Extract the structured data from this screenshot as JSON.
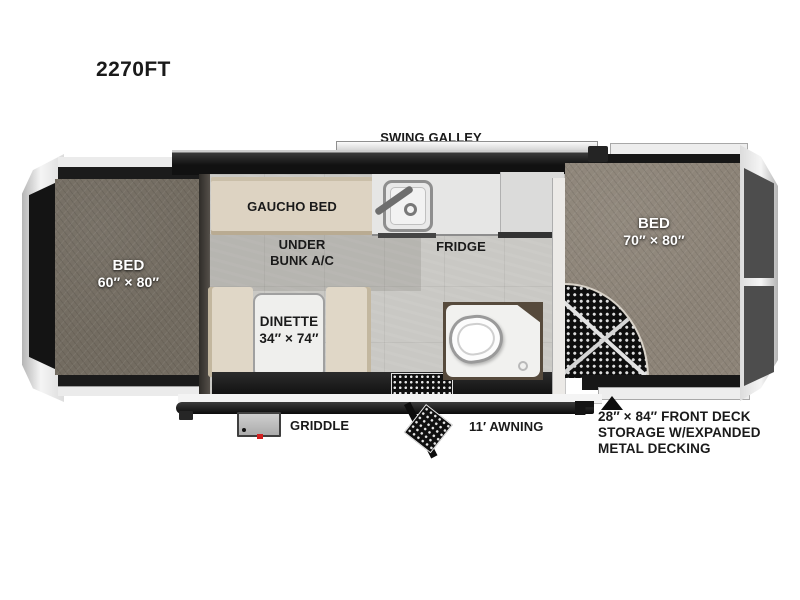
{
  "model": {
    "title": "2270FT"
  },
  "labels": {
    "swing_galley": "SWING GALLEY",
    "gaucho_bed": "GAUCHO BED",
    "under_bunk": [
      "UNDER",
      "BUNK A/C"
    ],
    "fridge": "FRIDGE",
    "bed_left": [
      "BED",
      "60″ × 80″"
    ],
    "bed_right": [
      "BED",
      "70″ × 80″"
    ],
    "dinette": [
      "DINETTE",
      "34″ × 74″"
    ],
    "griddle": "GRIDDLE",
    "awning": "11′ AWNING",
    "deck_note": [
      "28″ × 84″ FRONT DECK",
      "STORAGE W/EXPANDED",
      "METAL DECKING"
    ]
  },
  "icons": {
    "sink": "sink-icon",
    "faucet": "faucet-icon",
    "toilet": "toilet-icon",
    "shower": "shower-tray-icon",
    "drain": "drain-icon",
    "entry_mat": "entry-mat-icon",
    "entry_steps": "entry-steps-icon",
    "deck_mesh": "expanded-metal-decking",
    "pointer": "pointer-triangle-icon",
    "griddle_box": "griddle-icon"
  },
  "colors": {
    "background": "#ffffff",
    "text": "#1a1a1a",
    "bed_left_texture": "#736c61",
    "bed_right_texture": "#8d8478",
    "floor": "#c9c8c4",
    "cushion_beige": "#ddd3c2",
    "wall_black": "#161616",
    "frame_silver": "#ededed",
    "end_panel_gray": "#4d4d4d",
    "griddle_red": "#d21f1f"
  }
}
